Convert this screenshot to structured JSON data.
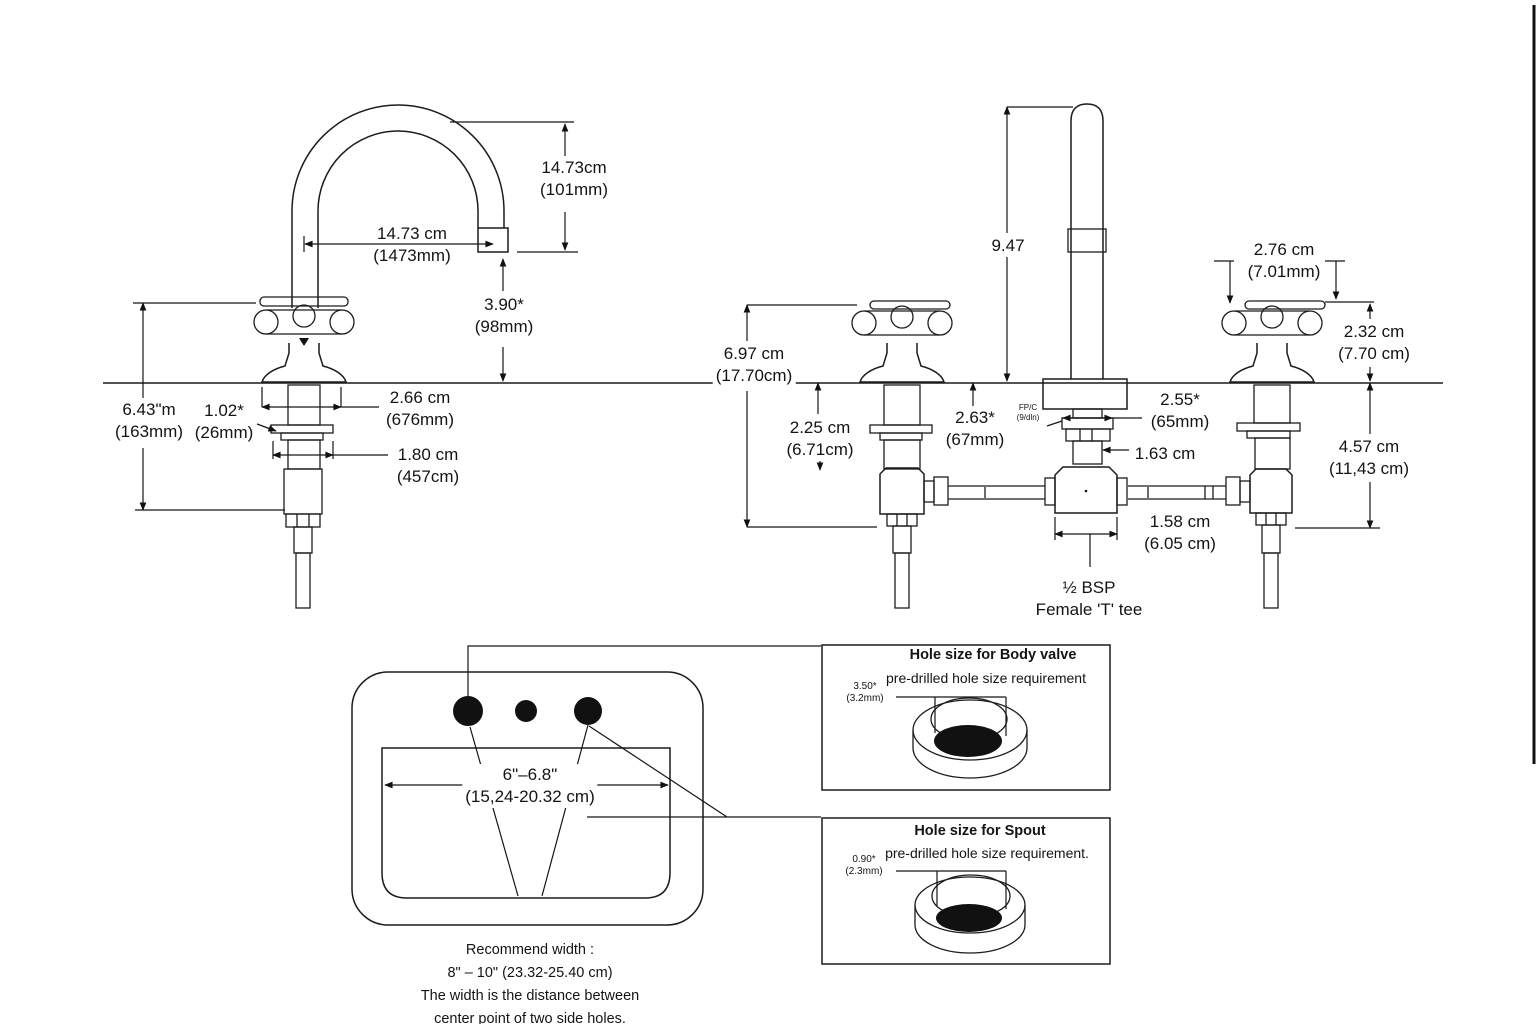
{
  "colors": {
    "line": "#1c1c1c",
    "text": "#141414",
    "background": "#ffffff"
  },
  "left_view": {
    "spout_height": {
      "l1": "14.73cm",
      "l2": "(101mm)"
    },
    "spout_reach": {
      "l1": "14.73 cm",
      "l2": "(1473mm)"
    },
    "spout_clearance": {
      "l1": "3.90*",
      "l2": "(98mm)"
    },
    "overall_height": {
      "l1": "6.43\"m",
      "l2": "(163mm)"
    },
    "washer": {
      "l1": "1.02*",
      "l2": "(26mm)"
    },
    "upper_shank": {
      "l1": "2.66 cm",
      "l2": "(676mm)"
    },
    "lower_shank": {
      "l1": "1.80 cm",
      "l2": "(457cm)"
    }
  },
  "front_view": {
    "spout_height": "9.47",
    "handle_width": {
      "l1": "2.76 cm",
      "l2": "(7.01mm)"
    },
    "handle_height": {
      "l1": "2.32 cm",
      "l2": "(7.70 cm)"
    },
    "overall_height": {
      "l1": "6.97 cm",
      "l2": "(17.70cm)"
    },
    "shank_exposed": {
      "l1": "2.25 cm",
      "l2": "(6.71cm)"
    },
    "left_spacing": {
      "l1": "2.63*",
      "l2": "(67mm)"
    },
    "right_spacing": {
      "l1": "2.55*",
      "l2": "(65mm)"
    },
    "tiny_note": {
      "l1": "FP/C",
      "l2": "(9/dln)"
    },
    "base_width": "1.63 cm",
    "tee_width": {
      "l1": "1.58 cm",
      "l2": "(6.05 cm)"
    },
    "valve_depth": {
      "l1": "4.57 cm",
      "l2": "(11,43 cm)"
    },
    "tee_label": {
      "l1": "½ BSP",
      "l2": "Female 'T' tee"
    }
  },
  "sink": {
    "hole_spread": {
      "l1": "6\"–6.8\"",
      "l2": "(15,24-20.32 cm)"
    },
    "note_l1": "Recommend width :",
    "note_l2": "8\" – 10\" (23.32-25.40 cm)",
    "note_l3": "The width is the distance between",
    "note_l4": "center point of two side holes."
  },
  "hole_boxes": {
    "body_valve": {
      "title": "Hole size for Body valve",
      "subtitle": "pre-drilled hole size requirement",
      "dim_l1": "3.50*",
      "dim_l2": "(3.2mm)"
    },
    "spout": {
      "title": "Hole size for Spout",
      "subtitle": "pre-drilled hole size requirement.",
      "dim_l1": "0.90*",
      "dim_l2": "(2.3mm)"
    }
  }
}
